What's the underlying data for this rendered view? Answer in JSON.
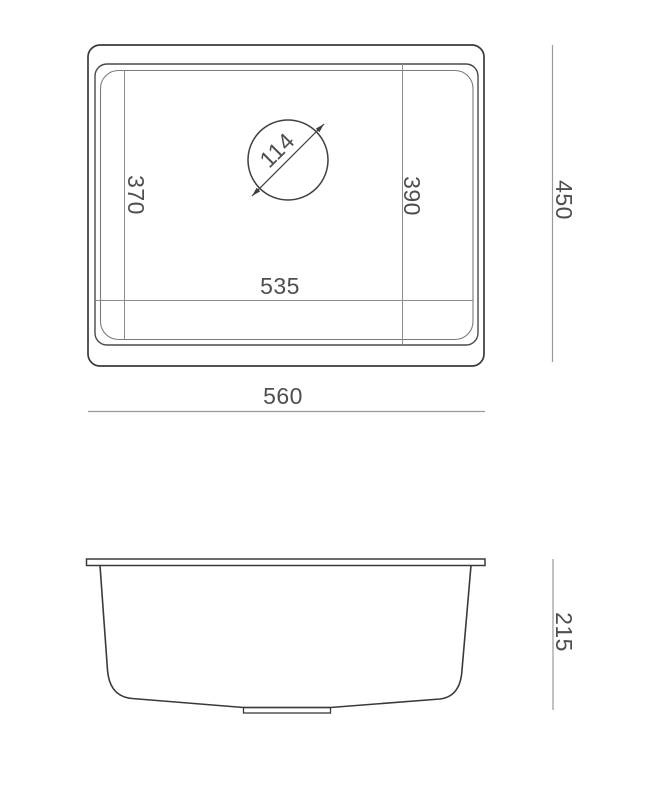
{
  "drawing": {
    "type": "sink-technical-drawing",
    "views": [
      "top-view",
      "side-view"
    ],
    "colors": {
      "background": "#ffffff",
      "outline": "#3a3a3a",
      "dimension_line": "#9a9a9a",
      "inner_dimension_line": "#8c8c8c",
      "label_text": "#4f4f4f"
    },
    "view_top": {
      "overall_width": "560",
      "overall_depth": "450",
      "bowl_length": "535",
      "bowl_width_left": "370",
      "bowl_width_right": "390",
      "drain_diameter": "114"
    },
    "view_side": {
      "height": "215"
    }
  }
}
